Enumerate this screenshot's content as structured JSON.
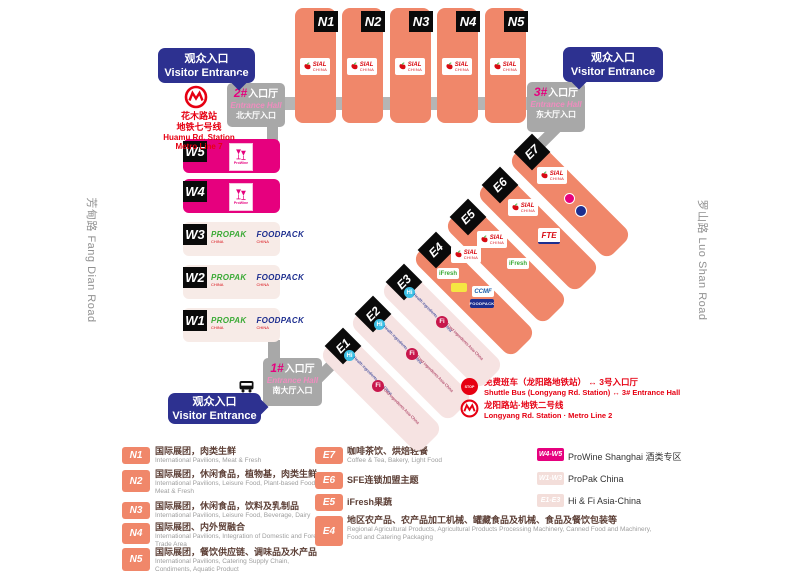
{
  "roads": {
    "left": "芳甸路 Fang Dian Road",
    "right": "罗山路 Luo Shan Road"
  },
  "visitor_entrance": {
    "cn": "观众入口",
    "en": "Visitor Entrance"
  },
  "entrance_halls": {
    "hall1": {
      "num": "1#",
      "cn": "入口厅",
      "en": "Entrance Hall",
      "sub": "南大厅入口"
    },
    "hall2": {
      "num": "2#",
      "cn": "入口厅",
      "en": "Entrance Hall",
      "sub": "北大厅入口"
    },
    "hall3": {
      "num": "3#",
      "cn": "入口厅",
      "en": "Entrance Hall",
      "sub": "东大厅入口"
    }
  },
  "huamu_station": {
    "cn1": "花木路站",
    "cn2": "地铁七号线",
    "en1": "Huamu Rd. Station",
    "en2": "Metro Line 7"
  },
  "shuttle": {
    "cn": "免费班车（龙阳路地铁站） ↔ 3号入口厅",
    "en": "Shuttle Bus (Longyang Rd. Station) ↔ 3# Entrance Hall"
  },
  "longyang_station": {
    "cn": "龙阳路站·地铁二号线",
    "en": "Longyang Rd. Station · Metro Line 2"
  },
  "halls": {
    "north": [
      "N1",
      "N2",
      "N3",
      "N4",
      "N5"
    ],
    "west": [
      "W5",
      "W4",
      "W3",
      "W2",
      "W1"
    ],
    "east": [
      "E1",
      "E2",
      "E3",
      "E4",
      "E5",
      "E6",
      "E7"
    ]
  },
  "logos": {
    "sial": "SIAL",
    "sial_sub": "CHINA",
    "prowine": "ProWine",
    "propak": "PROPAK",
    "propak_sub": "CHINA",
    "foodpack": "FOODPACK",
    "foodpack_sub": "CHINA",
    "fte": "FTE",
    "ifresh": "iFresh",
    "ccmf": "CCMF",
    "foodpack_navy": "FOODPACK",
    "hi": "Hi",
    "hi_text": "Health ingredients Asia-China",
    "fi": "Fi",
    "fi_text": "Food ingredients Asia-China",
    "stop": "STOP"
  },
  "legend": {
    "col1": [
      {
        "badge": "N1",
        "cn": "国际展团，肉类生鲜",
        "en": "International Pavilions, Meat & Fresh"
      },
      {
        "badge": "N2",
        "cn": "国际展团，休闲食品，植物基，肉类生鲜",
        "en": "International Pavilions, Leisure Food, Plant-based Food, Meat & Fresh"
      },
      {
        "badge": "N3",
        "cn": "国际展团，休闲食品，饮料及乳制品",
        "en": "International Pavilions, Leisure Food, Beverage, Dairy"
      },
      {
        "badge": "N4",
        "cn": "国际展团、内外贸融合",
        "en": "International Pavilions, Integration of Domestic and Foreign Trade Area"
      },
      {
        "badge": "N5",
        "cn": "国际展团，餐饮供应链、调味品及水产品",
        "en": "International Pavilions, Catering Supply Chain, Condiments, Aquatic Product"
      }
    ],
    "col2": [
      {
        "badge": "E7",
        "cn": "咖啡茶饮、烘焙轻餐",
        "en": "Coffee & Tea, Bakery, Light Food"
      },
      {
        "badge": "E6",
        "cn": "SFE连锁加盟主题",
        "en": ""
      },
      {
        "badge": "E5",
        "cn": "iFresh果蔬",
        "en": ""
      },
      {
        "badge": "E4",
        "cn": "地区农产品、农产品加工机械、罐藏食品及机械、食品及餐饮包装等",
        "en": "Regional Agricultural Products, Agricultural Products Processing Machinery, Canned Food and Machinery, Food and Catering Packaging"
      }
    ],
    "col3": [
      {
        "badge": "W4-W5",
        "label": "ProWine Shanghai 酒类专区"
      },
      {
        "badge": "W1-W3",
        "label": "ProPak China"
      },
      {
        "badge": "E1-E3",
        "label": "Hi & Fi Asia-China"
      }
    ]
  }
}
